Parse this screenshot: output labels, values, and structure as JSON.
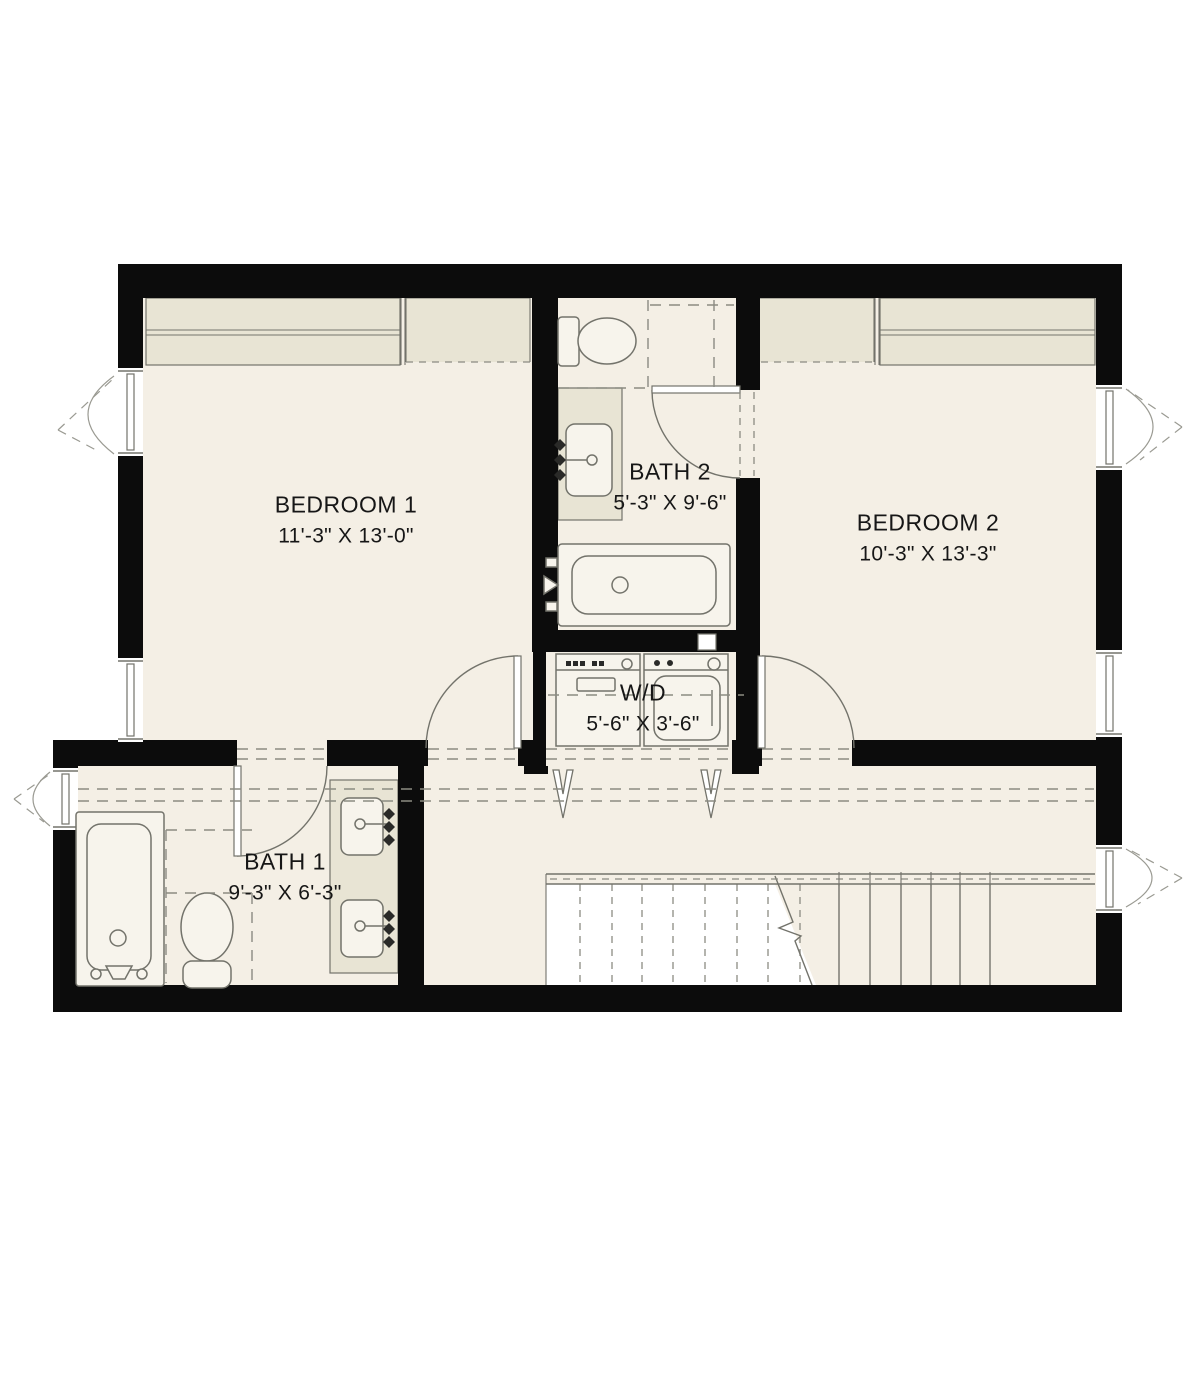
{
  "plan": {
    "type": "floor-plan",
    "colors": {
      "wall": "#0c0c0c",
      "floor": "#f4efe5",
      "builtin": "#e8e4d4",
      "line": "#73736b",
      "dash": "#8b8b82",
      "text": "#161616",
      "background": "#ffffff"
    },
    "rooms": [
      {
        "id": "bedroom-1",
        "name": "BEDROOM 1",
        "dimensions": "11'-3\" X 13'-0\""
      },
      {
        "id": "bath-2",
        "name": "BATH 2",
        "dimensions": "5'-3\" X 9'-6\""
      },
      {
        "id": "bedroom-2",
        "name": "BEDROOM 2",
        "dimensions": "10'-3\" X 13'-3\""
      },
      {
        "id": "laundry",
        "name": "W/D",
        "dimensions": "5'-6\" X 3'-6\""
      },
      {
        "id": "bath-1",
        "name": "BATH 1",
        "dimensions": "9'-3\" X 6'-3\""
      }
    ],
    "fixtures": [
      "toilet",
      "bathtub",
      "vanity-sink",
      "double-vanity",
      "washer",
      "dryer",
      "closet",
      "staircase",
      "stair-railing",
      "window",
      "door-swing",
      "bifold-doors"
    ]
  }
}
